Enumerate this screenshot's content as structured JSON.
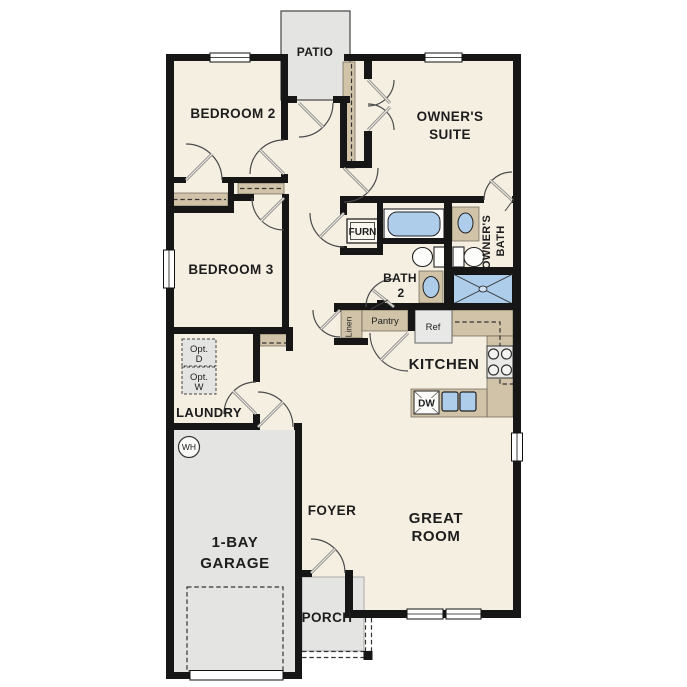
{
  "plan": {
    "type": "single-story residential floor plan",
    "rooms": {
      "patio": "PATIO",
      "bedroom2": "BEDROOM 2",
      "owners_suite": [
        "OWNER'S",
        "SUITE"
      ],
      "bedroom3": "BEDROOM 3",
      "furnace": "FURN",
      "bath2": [
        "BATH",
        "2"
      ],
      "owners_bath": [
        "OWNER'S",
        "BATH"
      ],
      "linen": "Linen",
      "pantry": "Pantry",
      "fridge": "Ref",
      "kitchen": "KITCHEN",
      "opt_dryer": [
        "Opt.",
        "D"
      ],
      "opt_washer": [
        "Opt.",
        "W"
      ],
      "laundry": "LAUNDRY",
      "water_heater": "WH",
      "dishwasher": "DW",
      "foyer": "FOYER",
      "garage": [
        "1-BAY",
        "GARAGE"
      ],
      "great_room": [
        "GREAT",
        "ROOM"
      ],
      "porch": "PORCH"
    },
    "colors": {
      "wall": "#161616",
      "interior_floor": "#f5efe2",
      "outdoor_and_garage": "#e4e4e2",
      "cabinet_tan": "#d0c3a8",
      "fixture_blue": "#aecdea",
      "background": "#ffffff"
    }
  }
}
